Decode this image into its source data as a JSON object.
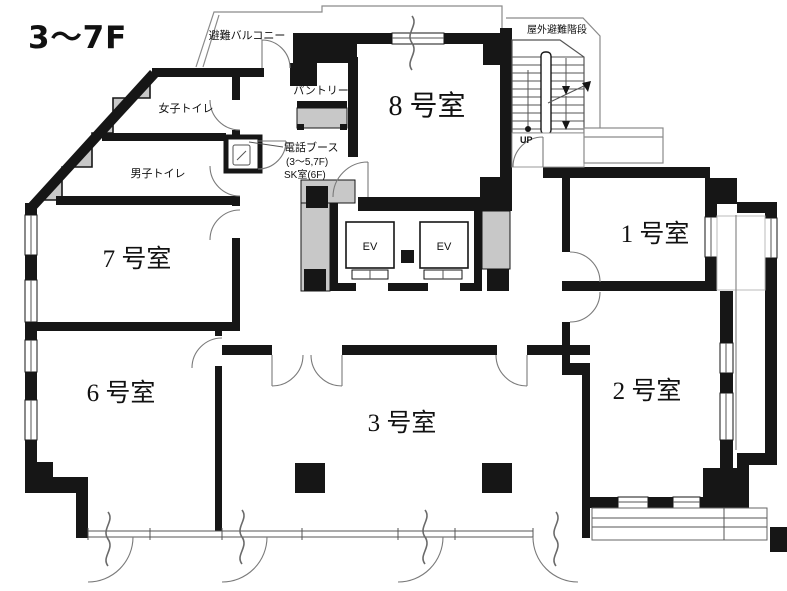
{
  "title": "3〜7F",
  "rooms": [
    {
      "name": "room-1",
      "label": "1 号室"
    },
    {
      "name": "room-2",
      "label": "2 号室"
    },
    {
      "name": "room-3",
      "label": "3 号室"
    },
    {
      "name": "room-6",
      "label": "6 号室"
    },
    {
      "name": "room-7",
      "label": "7 号室"
    },
    {
      "name": "room-8",
      "label": "8 号室"
    }
  ],
  "labels": {
    "evac_balcony": "避難バルコニー",
    "outdoor_evac_stairs": "屋外避難階段",
    "womens_toilet": "女子トイレ",
    "mens_toilet": "男子トイレ",
    "pantry": "パントリー",
    "phone_booth": "電話ブース",
    "phone_booth_floors": "(3〜5,7F)",
    "phone_booth_sk": "SK室(6F)",
    "up": "UP",
    "elevator": "EV"
  },
  "colors": {
    "wall": "#161616",
    "shade": "#c8c8c8",
    "background": "#ffffff"
  }
}
